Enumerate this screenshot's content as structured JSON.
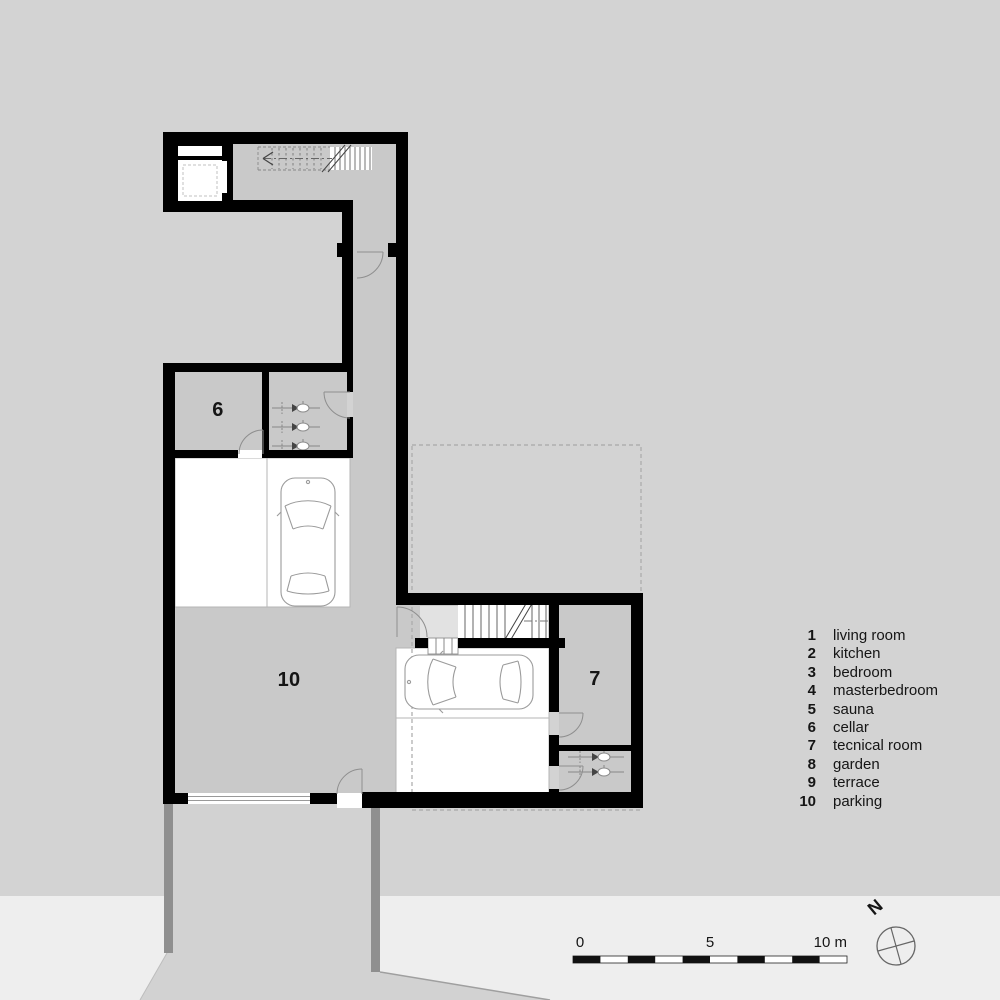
{
  "legend": {
    "items": [
      {
        "num": "1",
        "label": "living room"
      },
      {
        "num": "2",
        "label": "kitchen"
      },
      {
        "num": "3",
        "label": "bedroom"
      },
      {
        "num": "4",
        "label": "masterbedroom"
      },
      {
        "num": "5",
        "label": "sauna"
      },
      {
        "num": "6",
        "label": "cellar"
      },
      {
        "num": "7",
        "label": "tecnical room"
      },
      {
        "num": "8",
        "label": "garden"
      },
      {
        "num": "9",
        "label": "terrace"
      },
      {
        "num": "10",
        "label": "parking"
      }
    ]
  },
  "room_labels": {
    "cellar": "6",
    "technical_room": "7",
    "parking": "10"
  },
  "scale_bar": {
    "start": "0",
    "mid": "5",
    "end": "10 m"
  },
  "compass": {
    "north": "N"
  },
  "colors": {
    "background_upper": "#d3d3d3",
    "background_lower": "#eeeeee",
    "floor_gray": "#c9c9c9",
    "wall_black": "#000000",
    "parking_stall_white": "#ffffff",
    "retaining_wall_gray": "#8f8f8f",
    "landing_gray": "#e2e2e2",
    "dashed_outline_gray": "#a9a9a9"
  }
}
